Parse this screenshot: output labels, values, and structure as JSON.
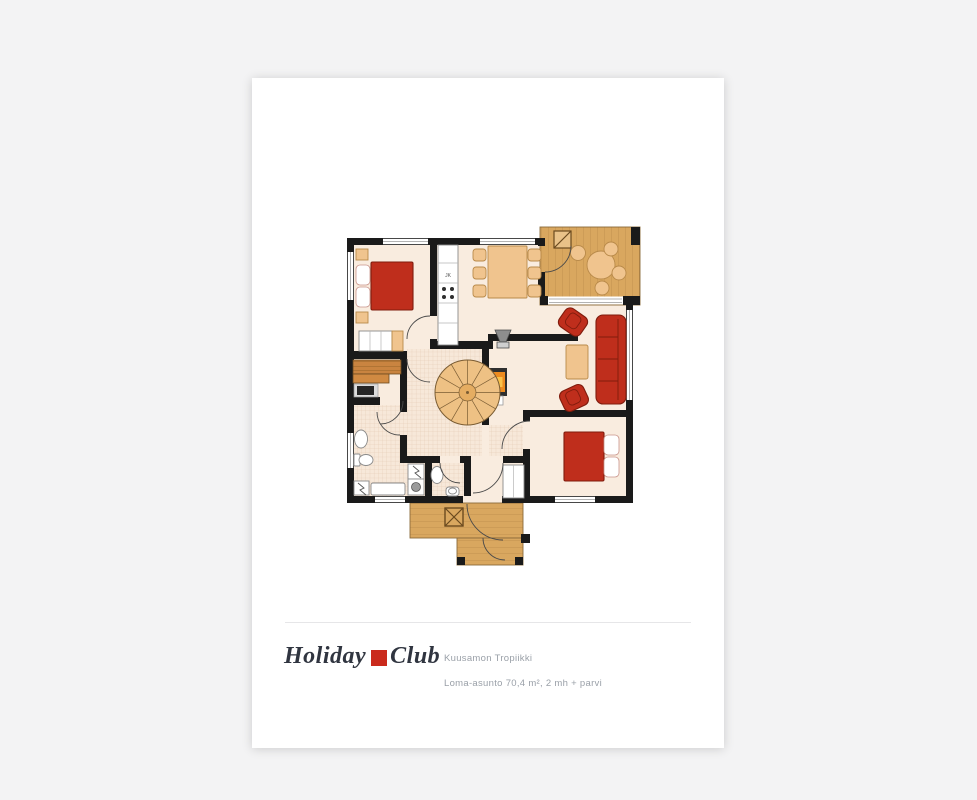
{
  "colors": {
    "canvas-bg": "#f3f3f4",
    "paper": "#ffffff",
    "wall": "#1a1a1a",
    "floor": "#f9ecdf",
    "tile-line": "#ddc1a8",
    "wood": "#d9a75f",
    "wood-line": "#bb8a4b",
    "wood-edge": "#7c5a2c",
    "sauna-wood": "#c98440",
    "furn-red": "#bf2e1c",
    "furn-red-dark": "#801c0d",
    "furn-tan": "#f0c48e",
    "furn-tan-dark": "#b98a4a",
    "fixture-stroke": "#8a8a8a",
    "door-arc": "#4a4a4a",
    "divider": "#e6e6e8",
    "logo-text": "#303540",
    "logo-red": "#ca2a1c",
    "caption-text": "#9aa0a8"
  },
  "plan": {
    "fridge_label": "JK"
  },
  "footer": {
    "logo_word1": "Holiday",
    "logo_word2": "Club",
    "title": "Kuusamon Tropiikki",
    "subtitle": "Loma-asunto 70,4 m², 2 mh + parvi"
  }
}
